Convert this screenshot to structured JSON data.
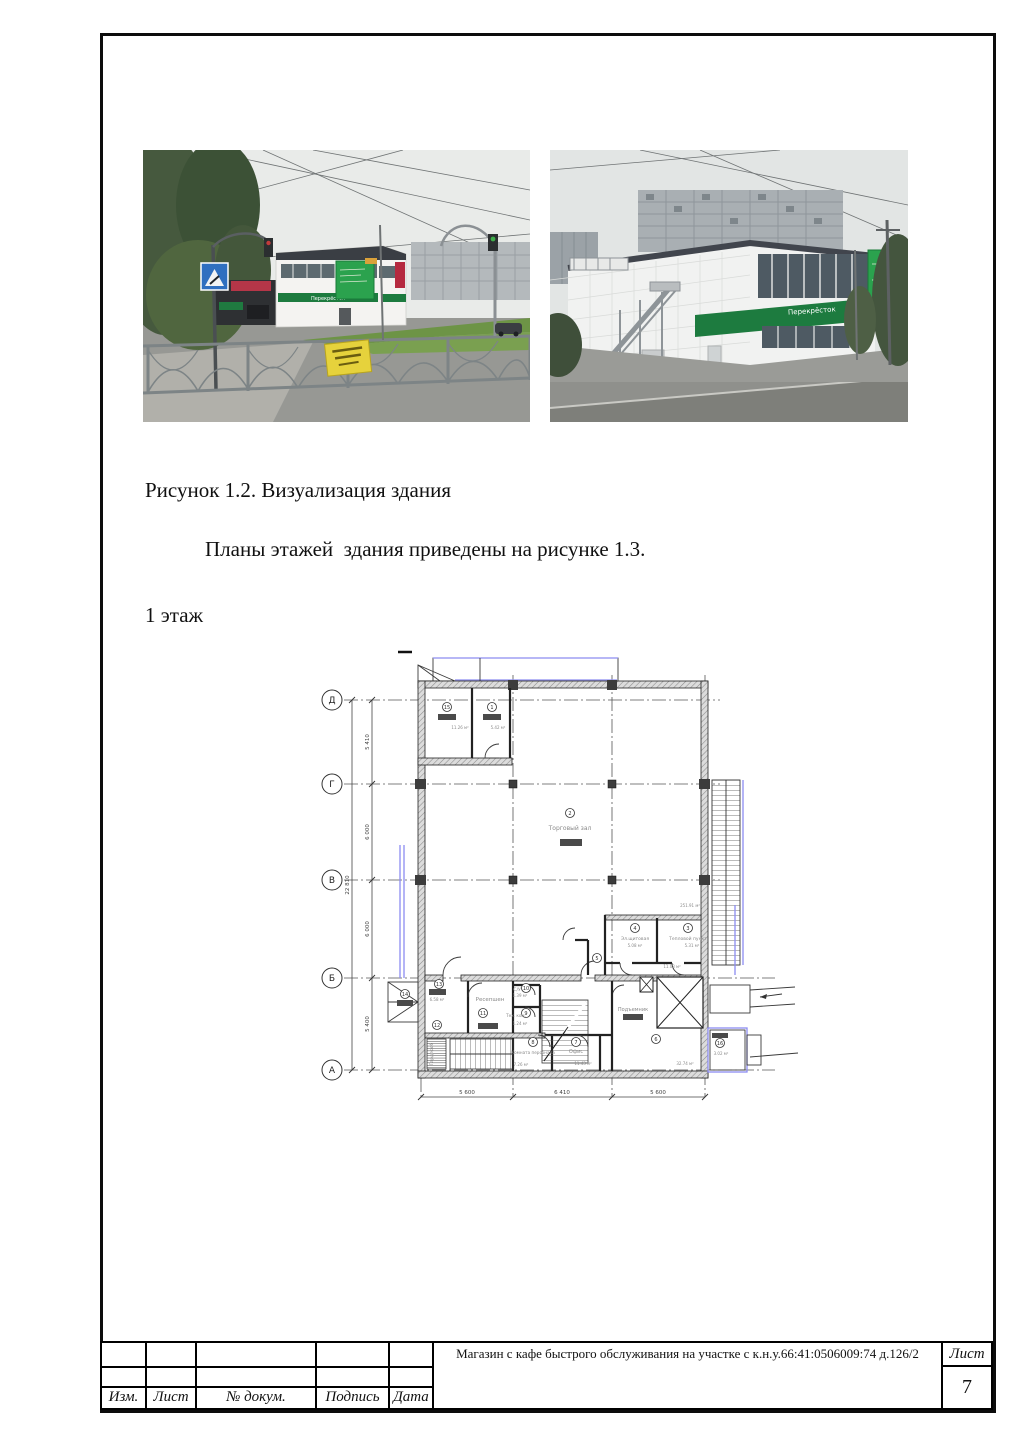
{
  "captions": {
    "figure": "Рисунок 1.2. Визуализация здания",
    "paragraph": "Планы этажей  здания приведены на рисунке 1.3.",
    "floor": "1 этаж"
  },
  "photos": {
    "sign_text": "Перекрёсток"
  },
  "plan": {
    "axes_rows": [
      "Д",
      "Г",
      "В",
      "Б",
      "А"
    ],
    "dims_bottom": [
      "5 600",
      "6 410",
      "5 600"
    ],
    "dims_left": [
      "5 410",
      "6 000",
      "6 000",
      "5 400"
    ],
    "dim_total": "22 810",
    "labels": {
      "lift": "Подъемник",
      "note_area": "251.91 м²"
    },
    "rooms": [
      {
        "num": "1",
        "name": "",
        "area": "5.42 м²"
      },
      {
        "num": "2",
        "name": "Торговый зал",
        "area": ""
      },
      {
        "num": "3",
        "name": "Тепловой пункт",
        "area": "5.31 м²"
      },
      {
        "num": "4",
        "name": "Эл.щитовая",
        "area": "5.08 м²"
      },
      {
        "num": "5",
        "name": "",
        "area": "11.03 м²"
      },
      {
        "num": "6",
        "name": "",
        "area": "32.74 м²"
      },
      {
        "num": "7",
        "name": "Офис",
        "area": "11.43 м²"
      },
      {
        "num": "8",
        "name": "Комната персонала",
        "area": "7.26 м²"
      },
      {
        "num": "9",
        "name": "Тех. ком.",
        "area": "1.24 м²"
      },
      {
        "num": "10",
        "name": "С/У",
        "area": "1.39 м²"
      },
      {
        "num": "11",
        "name": "Ресепшен",
        "area": ""
      },
      {
        "num": "12",
        "name": "Гардероб",
        "area": ""
      },
      {
        "num": "13",
        "name": "",
        "area": "6.58 м²"
      },
      {
        "num": "14",
        "name": "",
        "area": ""
      },
      {
        "num": "15",
        "name": "",
        "area": "11.26 м²"
      },
      {
        "num": "16",
        "name": "",
        "area": "3.02 м²"
      }
    ]
  },
  "title_block": {
    "cols": [
      "Изм.",
      "Лист",
      "№ докум.",
      "Подпись",
      "Дата"
    ],
    "doc_title": "Магазин с кафе быстрого обслуживания на участке с к.н.у.66:41:0506009:74 д.126/2",
    "sheet_label": "Лист",
    "sheet_number": "7"
  },
  "colors": {
    "brand_green": "#1d7b3f",
    "banner_green": "#2ba24e",
    "accent_blue": "#8c8cf0",
    "frame_black": "#0c0c0c"
  }
}
